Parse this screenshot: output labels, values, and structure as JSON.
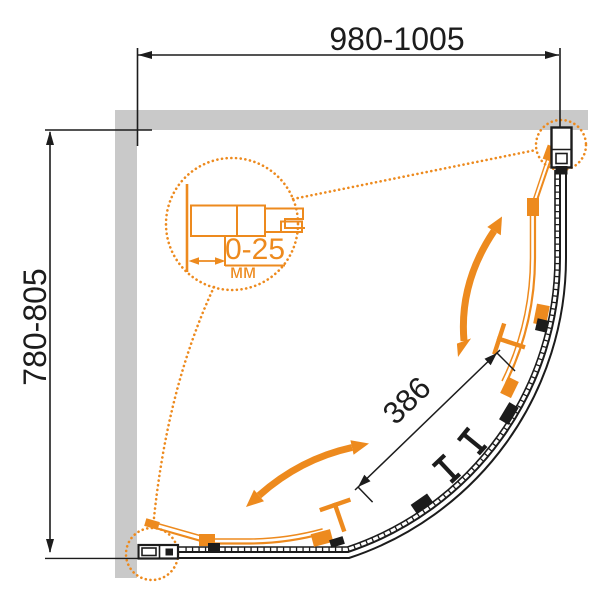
{
  "diagram": {
    "kind": "shower-enclosure-dimension-diagram",
    "dimensions": {
      "width_label": "980-1005",
      "depth_label": "780-805",
      "door_width_label": "386",
      "adjustment_range_label": "0-25",
      "adjustment_unit_label": "мм"
    },
    "colors": {
      "accent_orange": "#ED8A1E",
      "line_black": "#1C1C1C",
      "wall_gray": "#C9C9C9",
      "background": "#FFFFFF"
    }
  }
}
